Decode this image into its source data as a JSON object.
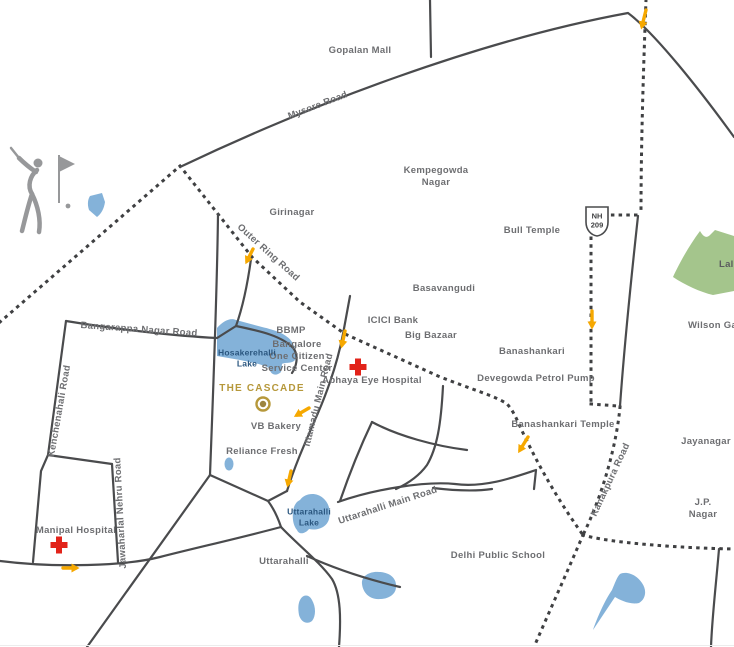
{
  "map": {
    "project_name": "THE CASCADE",
    "labels": {
      "gopalan_mall": "Gopalan Mall",
      "mysore_road": "Mysore Road",
      "girinagar": "Girinagar",
      "kempegowda_nagar": "Kempegowda\nNagar",
      "bull_temple": "Bull Temple",
      "nh_shield": "NH\n209",
      "lalbagh": "Lalbagh",
      "wilson_garden": "Wilson Garden",
      "outer_ring_road": "Outer Ring Road",
      "basavangudi": "Basavangudi",
      "icici_bank": "ICICI Bank",
      "big_bazaar": "Big Bazaar",
      "banashankari": "Banashankari",
      "bbmp": "BBMP",
      "bangalore_one": "Bangalore\nOne Citizen\nService Center",
      "hosakerehalli_lake": "Hosakerehalli\nLake",
      "the_cascade": "THE CASCADE",
      "abhaya_eye_hospital": "Abhaya Eye Hospital",
      "devegowda_petrol_pump": "Devegowda Petrol Pump",
      "banashankari_temple": "Banashankari Temple",
      "vb_bakery": "VB Bakery",
      "reliance_fresh": "Reliance Fresh",
      "ittamadu_main_road": "Ittamadu Main Road",
      "uttarahalli_lake": "Uttarahalli\nLake",
      "uttarahalli_main_road": "Uttarahalli Main Road",
      "uttarahalli": "Uttarahalli",
      "delhi_public_school": "Delhi Public School",
      "kanakpura_road": "Kanakpura Road",
      "jayanagar": "Jayanagar",
      "jp_nagar": "J.P. Nagar",
      "kenchenahali_road": "Kenchenahali Road",
      "jawaharlal_nehru_road": "Jawaharlal Nehru Road",
      "manipal_hospital": "Manipal Hospital",
      "bangarappa_nagar_road": "Bangarappa Nagar Road"
    },
    "colors": {
      "road_gray": "#4A4B4D",
      "dotted_route_gray": "#3F4042",
      "label_gray": "#6D6E71",
      "lake_blue": "#84B2D9",
      "lake_label_blue": "#2A567F",
      "park_green": "#A4C58C",
      "hospital_red": "#E2231A",
      "accent_gold": "#B6983B",
      "arrow_orange": "#F6A800",
      "icon_gray": "#97989A",
      "background": "#FFFFFF"
    },
    "icons": [
      "golfer-icon",
      "golf-flag-icon",
      "hospital-cross-icon",
      "cascade-location-marker",
      "nh209-shield",
      "direction-arrow"
    ]
  }
}
